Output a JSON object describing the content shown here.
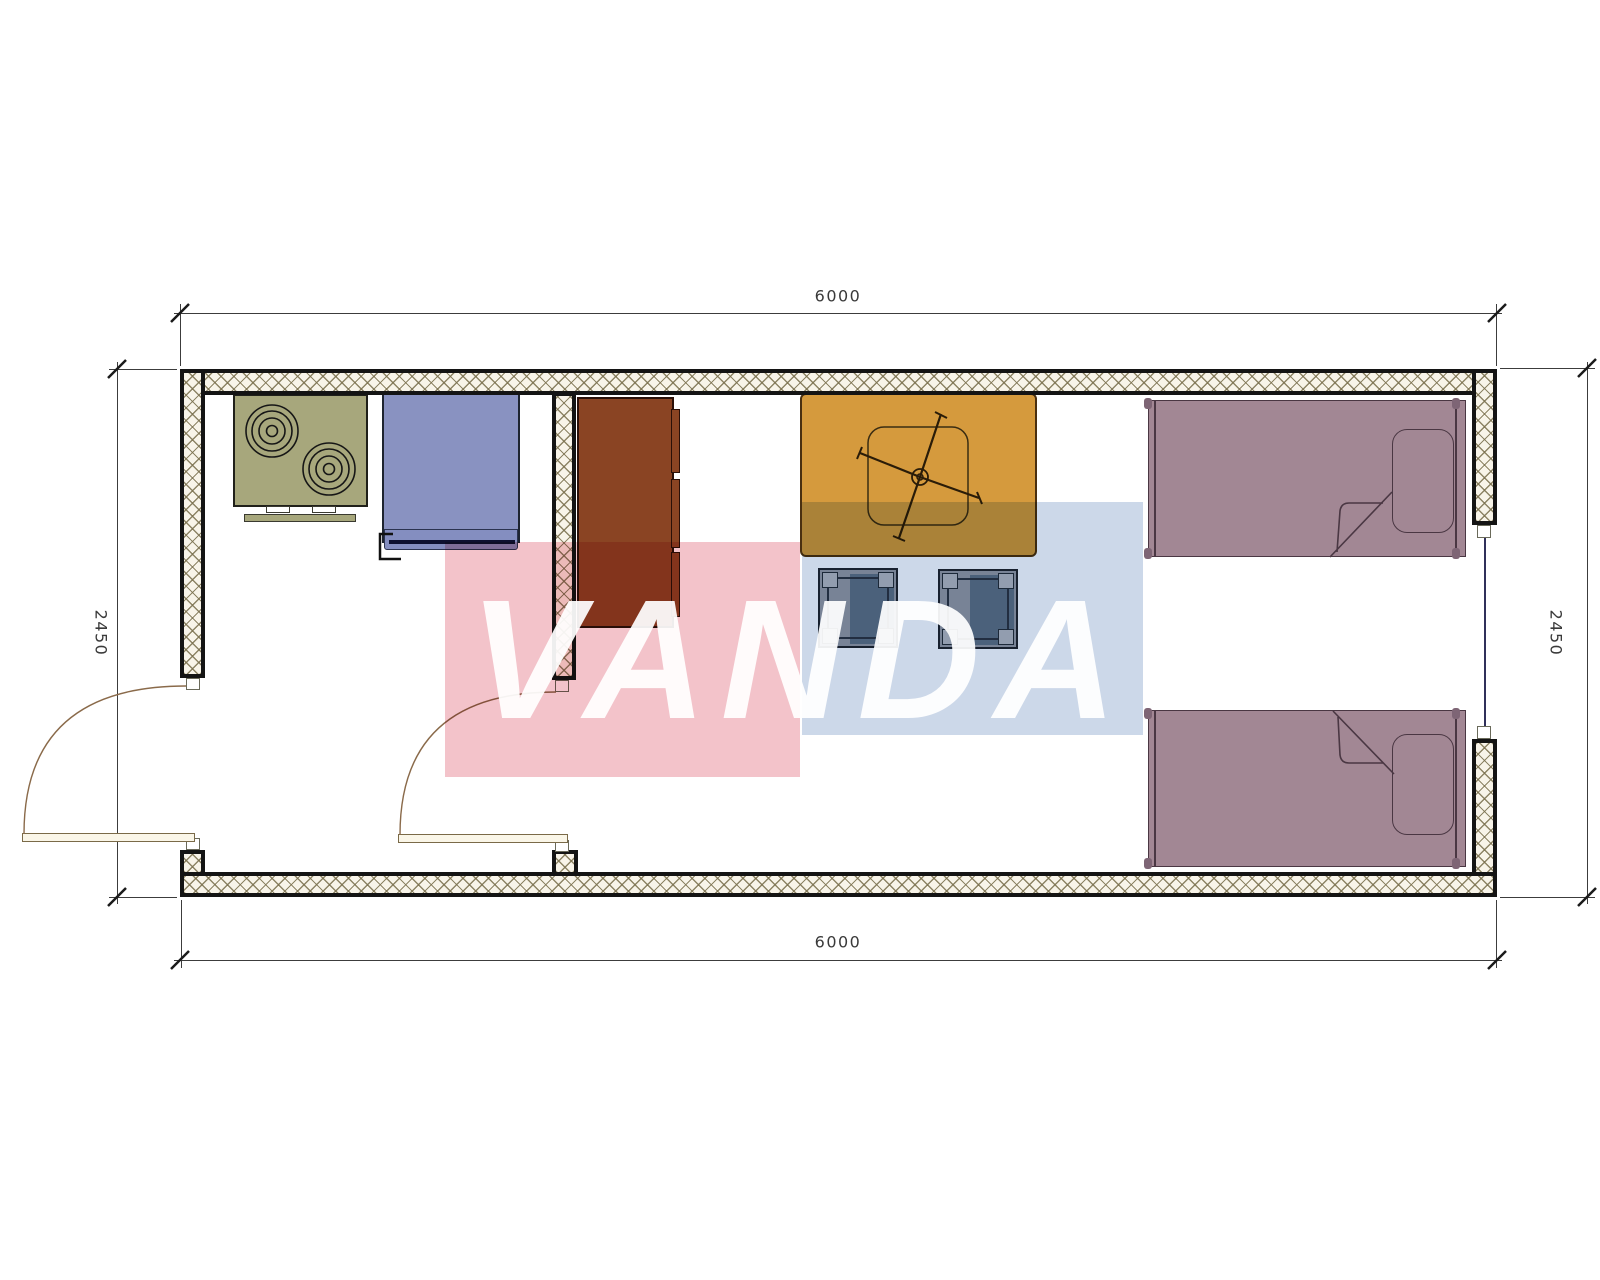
{
  "drawing": {
    "type": "floor-plan",
    "description": "container house plan view with kitchen, living area and two single beds"
  },
  "dimensions": {
    "top": "6000",
    "bottom": "6000",
    "left": "2450",
    "right": "2450"
  },
  "watermark": {
    "text": "VANDA",
    "pink_square": "#f3c3ca",
    "blue_square": "#ccd8e9",
    "text_color": "#ffffff"
  },
  "colors": {
    "wall_line": "#141414",
    "wall_hatch": "#7a704e",
    "stove": "#a7a77c",
    "sink_unit": "#8992c1",
    "cabinet": "#8a4423",
    "table": "#d59a3d",
    "stool": "#5d7287",
    "bed": "#a28794",
    "door_leaf": "#faf6e8",
    "dimension_text": "#3a3a3a"
  },
  "elements": [
    {
      "id": "stove",
      "name": "two-burner-stove"
    },
    {
      "id": "sink",
      "name": "sink-unit"
    },
    {
      "id": "cabinet",
      "name": "kitchen-cabinet"
    },
    {
      "id": "table",
      "name": "table-with-ceiling-fan"
    },
    {
      "id": "stool-1",
      "name": "stool"
    },
    {
      "id": "stool-2",
      "name": "stool"
    },
    {
      "id": "bed-top",
      "name": "single-bed"
    },
    {
      "id": "bed-bottom",
      "name": "single-bed"
    },
    {
      "id": "door-exterior",
      "name": "swing-door"
    },
    {
      "id": "door-interior",
      "name": "swing-door"
    },
    {
      "id": "window-right",
      "name": "window"
    }
  ]
}
